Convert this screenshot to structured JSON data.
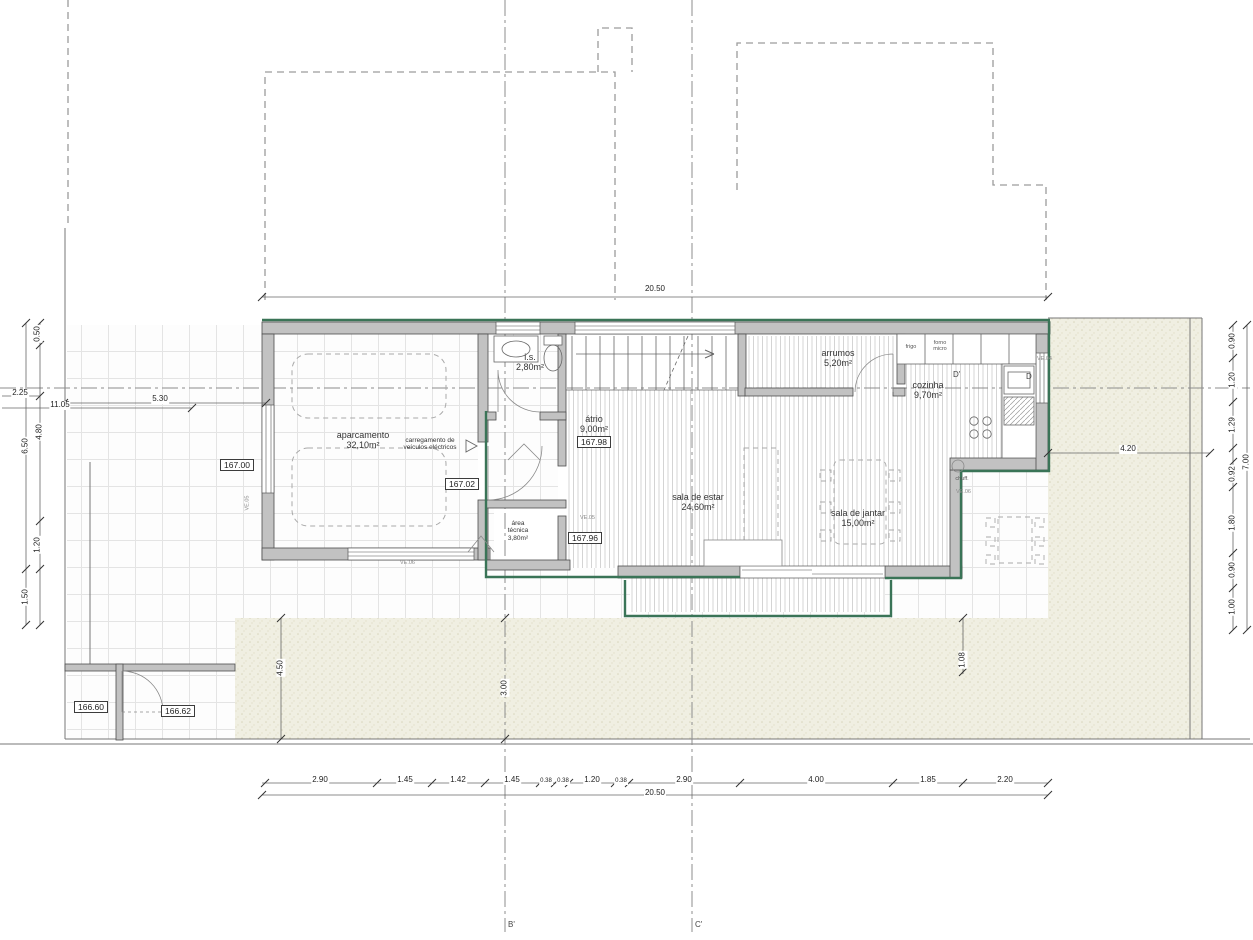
{
  "title": "Planta piso 0 - moradia",
  "rooms": {
    "aparcamento": {
      "name": "aparcamento",
      "area": "32,10m²"
    },
    "carregamento": {
      "line1": "carregamento de",
      "line2": "veículos eléctricos"
    },
    "is": {
      "name": "i.s.",
      "area": "2,80m²"
    },
    "atrio": {
      "name": "átrio",
      "area": "9,00m²"
    },
    "arrumos": {
      "name": "arrumos",
      "area": "5,20m²"
    },
    "cozinha": {
      "name": "cozinha",
      "area": "9,70m²"
    },
    "sala_estar": {
      "name": "sala de estar",
      "area": "24,60m²"
    },
    "sala_jantar": {
      "name": "sala de jantar",
      "area": "15,00m²"
    },
    "area_tecnica": {
      "line1": "área",
      "line2": "técnica",
      "area": "3,80m²"
    },
    "chuff": "chuff."
  },
  "appliances": {
    "frigo": "frigo",
    "forno": "forno",
    "micro": "micro"
  },
  "levels": {
    "l167_00": "167.00",
    "l167_02": "167.02",
    "l167_98": "167.98",
    "l167_96": "167.96",
    "l166_60": "166.60",
    "l166_62": "166.62"
  },
  "dims": {
    "top_total": "20.50",
    "bottom_total": "20.50",
    "bottom": [
      "2.90",
      "1.45",
      "1.42",
      "1.45",
      "0.38",
      "0.38",
      "1.20",
      "0.38",
      "2.90",
      "4.00",
      "1.85",
      "2.20"
    ],
    "left": {
      "d050": "0.50",
      "d225": "2.25",
      "d1105": "11.05",
      "d530": "5.30",
      "d480": "4.80",
      "d650": "6.50",
      "d120": "1.20",
      "d150": "1.50"
    },
    "right": {
      "d090a": "0.90",
      "d120": "1.20",
      "d129": "1.29",
      "d092": "0.92",
      "d180": "1.80",
      "d090b": "0.90",
      "d100": "1.00",
      "d700": "7.00",
      "d420": "4.20"
    },
    "inner": {
      "d450": "4.50",
      "d300": "3.00",
      "d108": "1.08"
    }
  },
  "sections": {
    "b": "B'",
    "c": "C'",
    "d": "D",
    "d_prime": "D'"
  },
  "windows": {
    "ve_garage_left": "VE.05",
    "ve_garage_bottom": "VE.06",
    "ve_hall": "VE.05",
    "ve_kitchen": "VE.04",
    "ve_terrace": "VE.06"
  },
  "colors": {
    "wall_fill": "#c2c2c2",
    "wall_edge": "#4d4d4d",
    "green_accent": "#3a7457",
    "stipple_bg": "#f0efe2",
    "tile_line": "#e4e4e4",
    "hatch_line": "#d4d4d4",
    "dash_line": "#9c9c9c"
  }
}
